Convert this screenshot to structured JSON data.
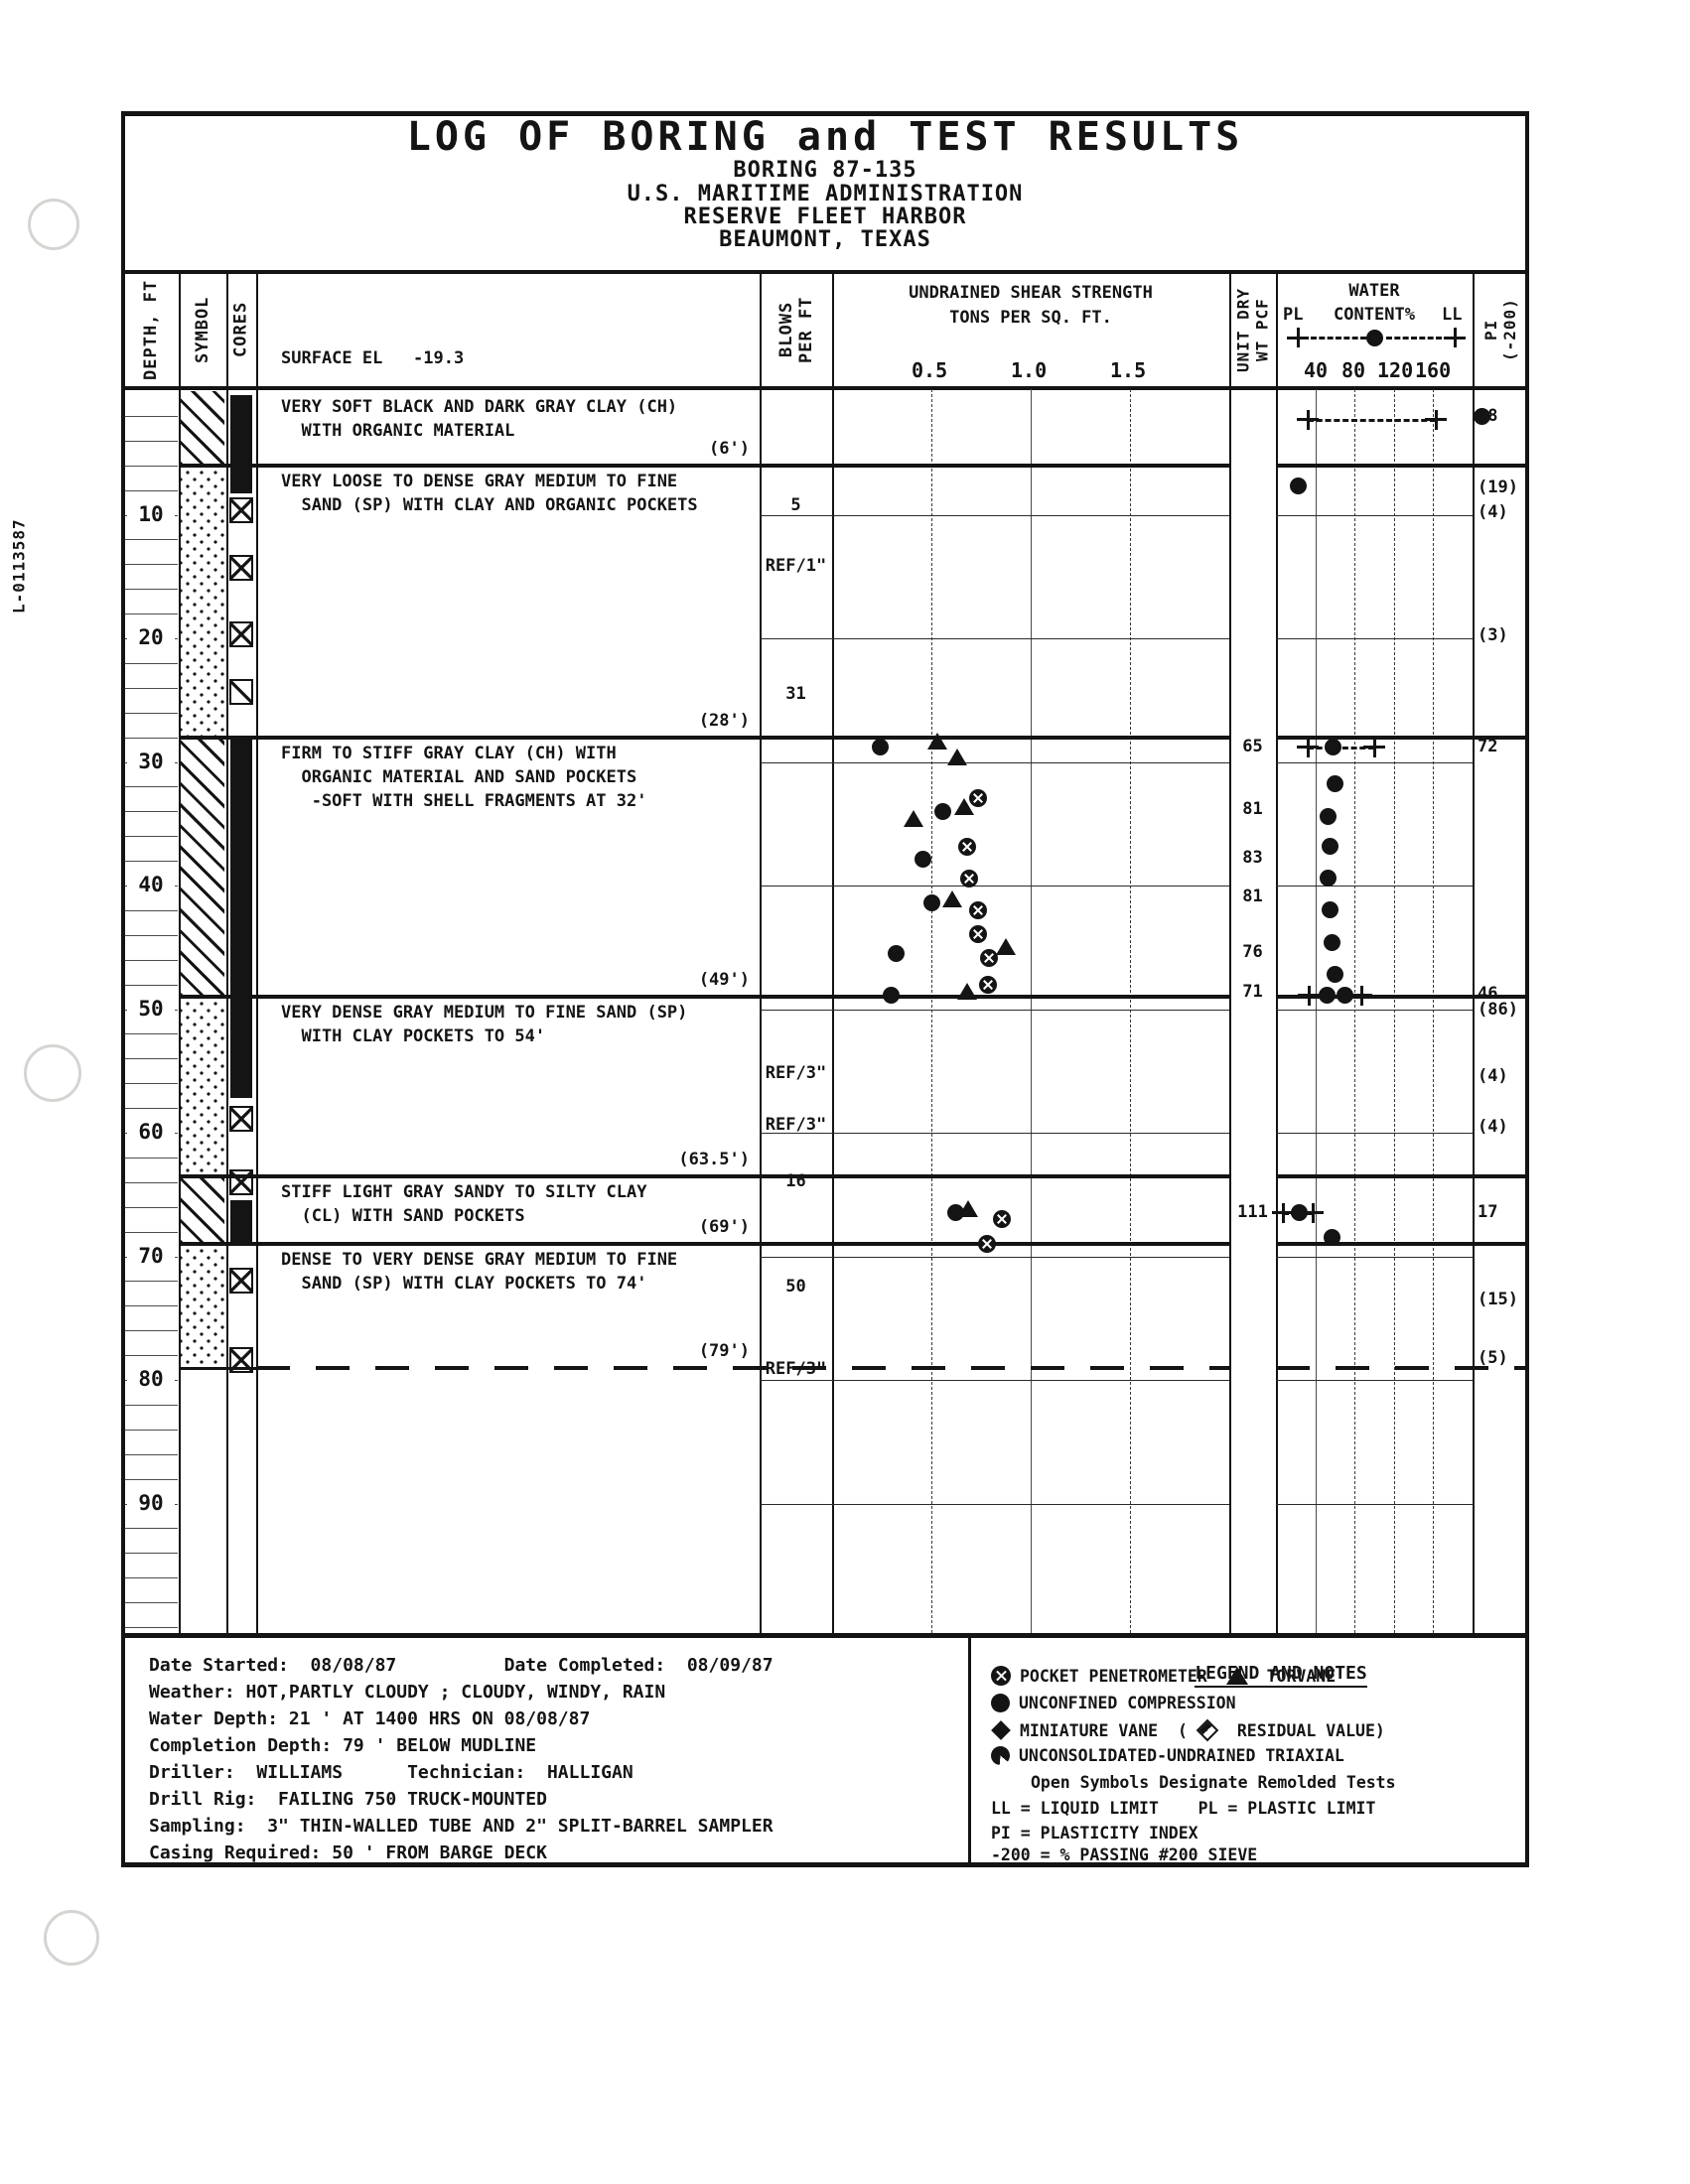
{
  "page": {
    "side_label": "L-0113587"
  },
  "title_block": {
    "title": "LOG OF BORING and TEST RESULTS",
    "subtitle1": "BORING 87-135",
    "subtitle2": "U.S. MARITIME ADMINISTRATION",
    "subtitle3": "RESERVE FLEET HARBOR",
    "subtitle4": "BEAUMONT, TEXAS"
  },
  "columns": {
    "depth": "DEPTH, FT",
    "symbol": "SYMBOL",
    "cores": "CORES",
    "surface_el": "SURFACE EL   -19.3",
    "blows": "BLOWS\nPER FT",
    "shear_title1": "UNDRAINED SHEAR STRENGTH",
    "shear_title2": "TONS PER SQ. FT.",
    "shear_ticks": [
      "0.5",
      "1.0",
      "1.5"
    ],
    "unit_wt": "UNIT DRY\nWT PCF",
    "water_title": "WATER",
    "water_pl": "PL",
    "water_content": "CONTENT%",
    "water_ll": "LL",
    "water_ticks": [
      "40",
      "80",
      "120",
      "160"
    ],
    "pi": "PI\n(-200)"
  },
  "log": {
    "depth_labels": [
      10,
      20,
      30,
      40,
      50,
      60,
      70,
      80,
      90
    ],
    "layers": [
      {
        "top": 0,
        "bottom": 6,
        "pattern": "clay",
        "lines": [
          "VERY SOFT BLACK AND DARK GRAY CLAY (CH)",
          "  WITH ORGANIC MATERIAL"
        ],
        "tag": "(6')"
      },
      {
        "top": 6,
        "bottom": 28,
        "pattern": "sand",
        "lines": [
          "VERY LOOSE TO DENSE GRAY MEDIUM TO FINE",
          "  SAND (SP) WITH CLAY AND ORGANIC POCKETS"
        ],
        "tag": "(28')"
      },
      {
        "top": 28,
        "bottom": 49,
        "pattern": "clay",
        "lines": [
          "FIRM TO STIFF GRAY CLAY (CH) WITH",
          "  ORGANIC MATERIAL AND SAND POCKETS",
          "   -SOFT WITH SHELL FRAGMENTS AT 32'"
        ],
        "tag": "(49')"
      },
      {
        "top": 49,
        "bottom": 63.5,
        "pattern": "sand",
        "lines": [
          "VERY DENSE GRAY MEDIUM TO FINE SAND (SP)",
          "  WITH CLAY POCKETS TO 54'"
        ],
        "tag": "(63.5')"
      },
      {
        "top": 63.5,
        "bottom": 69,
        "pattern": "clay",
        "lines": [
          "STIFF LIGHT GRAY SANDY TO SILTY CLAY",
          "  (CL) WITH SAND POCKETS"
        ],
        "tag": "(69')"
      },
      {
        "top": 69,
        "bottom": 79,
        "pattern": "sand",
        "boundary": "dashed",
        "lines": [
          "DENSE TO VERY DENSE GRAY MEDIUM TO FINE",
          "  SAND (SP) WITH CLAY POCKETS TO 74'"
        ],
        "tag": "(79')"
      }
    ],
    "cores": [
      {
        "type": "bar",
        "top": 0.3,
        "bottom": 8.3
      },
      {
        "type": "x",
        "ft": 9.6
      },
      {
        "type": "x",
        "ft": 14.3
      },
      {
        "type": "x",
        "ft": 19.7
      },
      {
        "type": "slash",
        "ft": 24.3
      },
      {
        "type": "bar",
        "top": 28.0,
        "bottom": 57.2
      },
      {
        "type": "x",
        "ft": 58.9
      },
      {
        "type": "x",
        "ft": 64.0
      },
      {
        "type": "bar",
        "top": 65.5,
        "bottom": 69.0
      },
      {
        "type": "x",
        "ft": 72.0
      },
      {
        "type": "x",
        "ft": 78.4
      }
    ],
    "blows": [
      {
        "text": "5",
        "ft": 9.3
      },
      {
        "text": "REF/1\"",
        "ft": 14.2
      },
      {
        "text": "31",
        "ft": 24.6
      },
      {
        "text": "REF/3\"",
        "ft": 55.3
      },
      {
        "text": "REF/3\"",
        "ft": 59.4
      },
      {
        "text": "16",
        "ft": 64.0
      },
      {
        "text": "50",
        "ft": 72.5
      },
      {
        "text": "REF/3\"",
        "ft": 79.2
      }
    ],
    "unit_dry_wt": [
      {
        "v": "65",
        "ft": 28.8
      },
      {
        "v": "81",
        "ft": 33.9
      },
      {
        "v": "83",
        "ft": 37.8
      },
      {
        "v": "81",
        "ft": 41.0
      },
      {
        "v": "76",
        "ft": 45.5
      },
      {
        "v": "71",
        "ft": 48.7
      },
      {
        "v": "111",
        "ft": 66.5
      }
    ],
    "pi_values": [
      {
        "ft": 2.1,
        "text": "98",
        "wc_dot": true
      },
      {
        "ft": 7.9,
        "text": "(19)"
      },
      {
        "ft": 9.9,
        "text": "(4)"
      },
      {
        "ft": 19.8,
        "text": "(3)"
      },
      {
        "ft": 28.8,
        "text": "72"
      },
      {
        "ft": 48.8,
        "text": "46"
      },
      {
        "ft": 50.1,
        "text": "(86)"
      },
      {
        "ft": 55.5,
        "text": "(4)"
      },
      {
        "ft": 59.6,
        "text": "(4)"
      },
      {
        "ft": 66.5,
        "text": "17"
      },
      {
        "ft": 73.6,
        "text": "(15)"
      },
      {
        "ft": 78.3,
        "text": "(5)"
      }
    ],
    "boring_end_ft": 79
  },
  "chart_data": {
    "type": "scatter",
    "title": "UNDRAINED SHEAR STRENGTH",
    "xlabel": "TONS PER SQ. FT.",
    "ylabel": "DEPTH, FT",
    "xlim": [
      0,
      2
    ],
    "x_ticks": [
      0.5,
      1.0,
      1.5
    ],
    "series": [
      {
        "name": "POCKET PENETROMETER",
        "symbol": "circle-x",
        "points": [
          [
            0.735,
            32.9
          ],
          [
            0.68,
            36.9
          ],
          [
            0.69,
            39.4
          ],
          [
            0.735,
            42.0
          ],
          [
            0.735,
            43.9
          ],
          [
            0.79,
            45.9
          ],
          [
            0.785,
            48.0
          ],
          [
            0.855,
            67.0
          ],
          [
            0.78,
            69.0
          ]
        ]
      },
      {
        "name": "TORVANE",
        "symbol": "triangle",
        "points": [
          [
            0.53,
            28.4
          ],
          [
            0.63,
            29.7
          ],
          [
            0.665,
            33.7
          ],
          [
            0.41,
            34.7
          ],
          [
            0.605,
            41.2
          ],
          [
            0.875,
            45.1
          ],
          [
            0.68,
            48.7
          ],
          [
            0.685,
            66.3
          ]
        ]
      },
      {
        "name": "UNCONFINED COMPRESSION",
        "symbol": "filled-circle",
        "points": [
          [
            0.24,
            28.8
          ],
          [
            0.555,
            34.0
          ],
          [
            0.455,
            37.9
          ],
          [
            0.5,
            41.4
          ],
          [
            0.32,
            45.5
          ],
          [
            0.295,
            48.9
          ],
          [
            0.62,
            66.5
          ]
        ]
      }
    ]
  },
  "water_content": {
    "limit_bars": [
      {
        "ft": 2.3,
        "pl": 32,
        "ll": 163,
        "wc": null
      },
      {
        "ft": 28.8,
        "pl": 32,
        "wc": 58,
        "ll": 100
      },
      {
        "ft": 48.9,
        "pl": 33,
        "wc": 52,
        "wc2": 70,
        "ll": 87
      },
      {
        "ft": 66.5,
        "pl": 7,
        "wc": 23,
        "ll": 37
      }
    ],
    "dots": [
      {
        "ft": 7.7,
        "wc": 22
      },
      {
        "ft": 31.8,
        "wc": 60
      },
      {
        "ft": 34.4,
        "wc": 53
      },
      {
        "ft": 36.8,
        "wc": 55
      },
      {
        "ft": 39.4,
        "wc": 53
      },
      {
        "ft": 42.0,
        "wc": 55
      },
      {
        "ft": 44.6,
        "wc": 57
      },
      {
        "ft": 47.2,
        "wc": 60
      },
      {
        "ft": 68.5,
        "wc": 57
      }
    ]
  },
  "notes": {
    "lines": [
      "Date Started:  08/08/87          Date Completed:  08/09/87",
      "Weather: HOT,PARTLY CLOUDY ; CLOUDY, WINDY, RAIN",
      "Water Depth: 21 ' AT 1400 HRS ON 08/08/87",
      "Completion Depth: 79 ' BELOW MUDLINE",
      "Driller:  WILLIAMS      Technician:  HALLIGAN",
      "Drill Rig:  FAILING 750 TRUCK-MOUNTED",
      "Sampling:  3\" THIN-WALLED TUBE AND 2\" SPLIT-BARREL SAMPLER",
      "Casing Required: 50 ' FROM BARGE DECK"
    ]
  },
  "legend": {
    "title": "LEGEND AND NOTES",
    "rows": [
      {
        "indent": 0,
        "segs": [
          {
            "icon": "pocket-penetrometer-icon",
            "cls": "lg-pp"
          },
          {
            "t": "POCKET PENETROMETER "
          },
          {
            "icon": "torvane-icon",
            "cls": "lg-tv"
          },
          {
            "t": " TORVANE"
          }
        ]
      },
      {
        "indent": 0,
        "segs": [
          {
            "icon": "unconfined-compression-icon",
            "cls": "lg-uc"
          },
          {
            "t": "UNCONFINED COMPRESSION"
          }
        ]
      },
      {
        "indent": 0,
        "segs": [
          {
            "icon": "miniature-vane-icon",
            "cls": "lg-mv"
          },
          {
            "t": "MINIATURE VANE  ("
          },
          {
            "icon": "residual-vane-icon",
            "cls": "lg-mvr"
          },
          {
            "t": " RESIDUAL VALUE)"
          }
        ]
      },
      {
        "indent": 0,
        "segs": [
          {
            "icon": "uu-triaxial-icon",
            "cls": "lg-uu"
          },
          {
            "t": "UNCONSOLIDATED-UNDRAINED TRIAXIAL"
          }
        ]
      },
      {
        "indent": 1,
        "segs": [
          {
            "t": "Open Symbols Designate Remolded Tests"
          }
        ]
      },
      {
        "indent": 0,
        "segs": [
          {
            "t": "LL = LIQUID LIMIT    PL = PLASTIC LIMIT"
          }
        ]
      },
      {
        "indent": 0,
        "segs": [
          {
            "t": "PI = PLASTICITY INDEX"
          }
        ]
      },
      {
        "indent": 0,
        "segs": [
          {
            "t": "-200 = % PASSING #200 SIEVE"
          }
        ]
      }
    ]
  },
  "colors": {
    "ink": "#141414",
    "paper": "#ffffff"
  }
}
